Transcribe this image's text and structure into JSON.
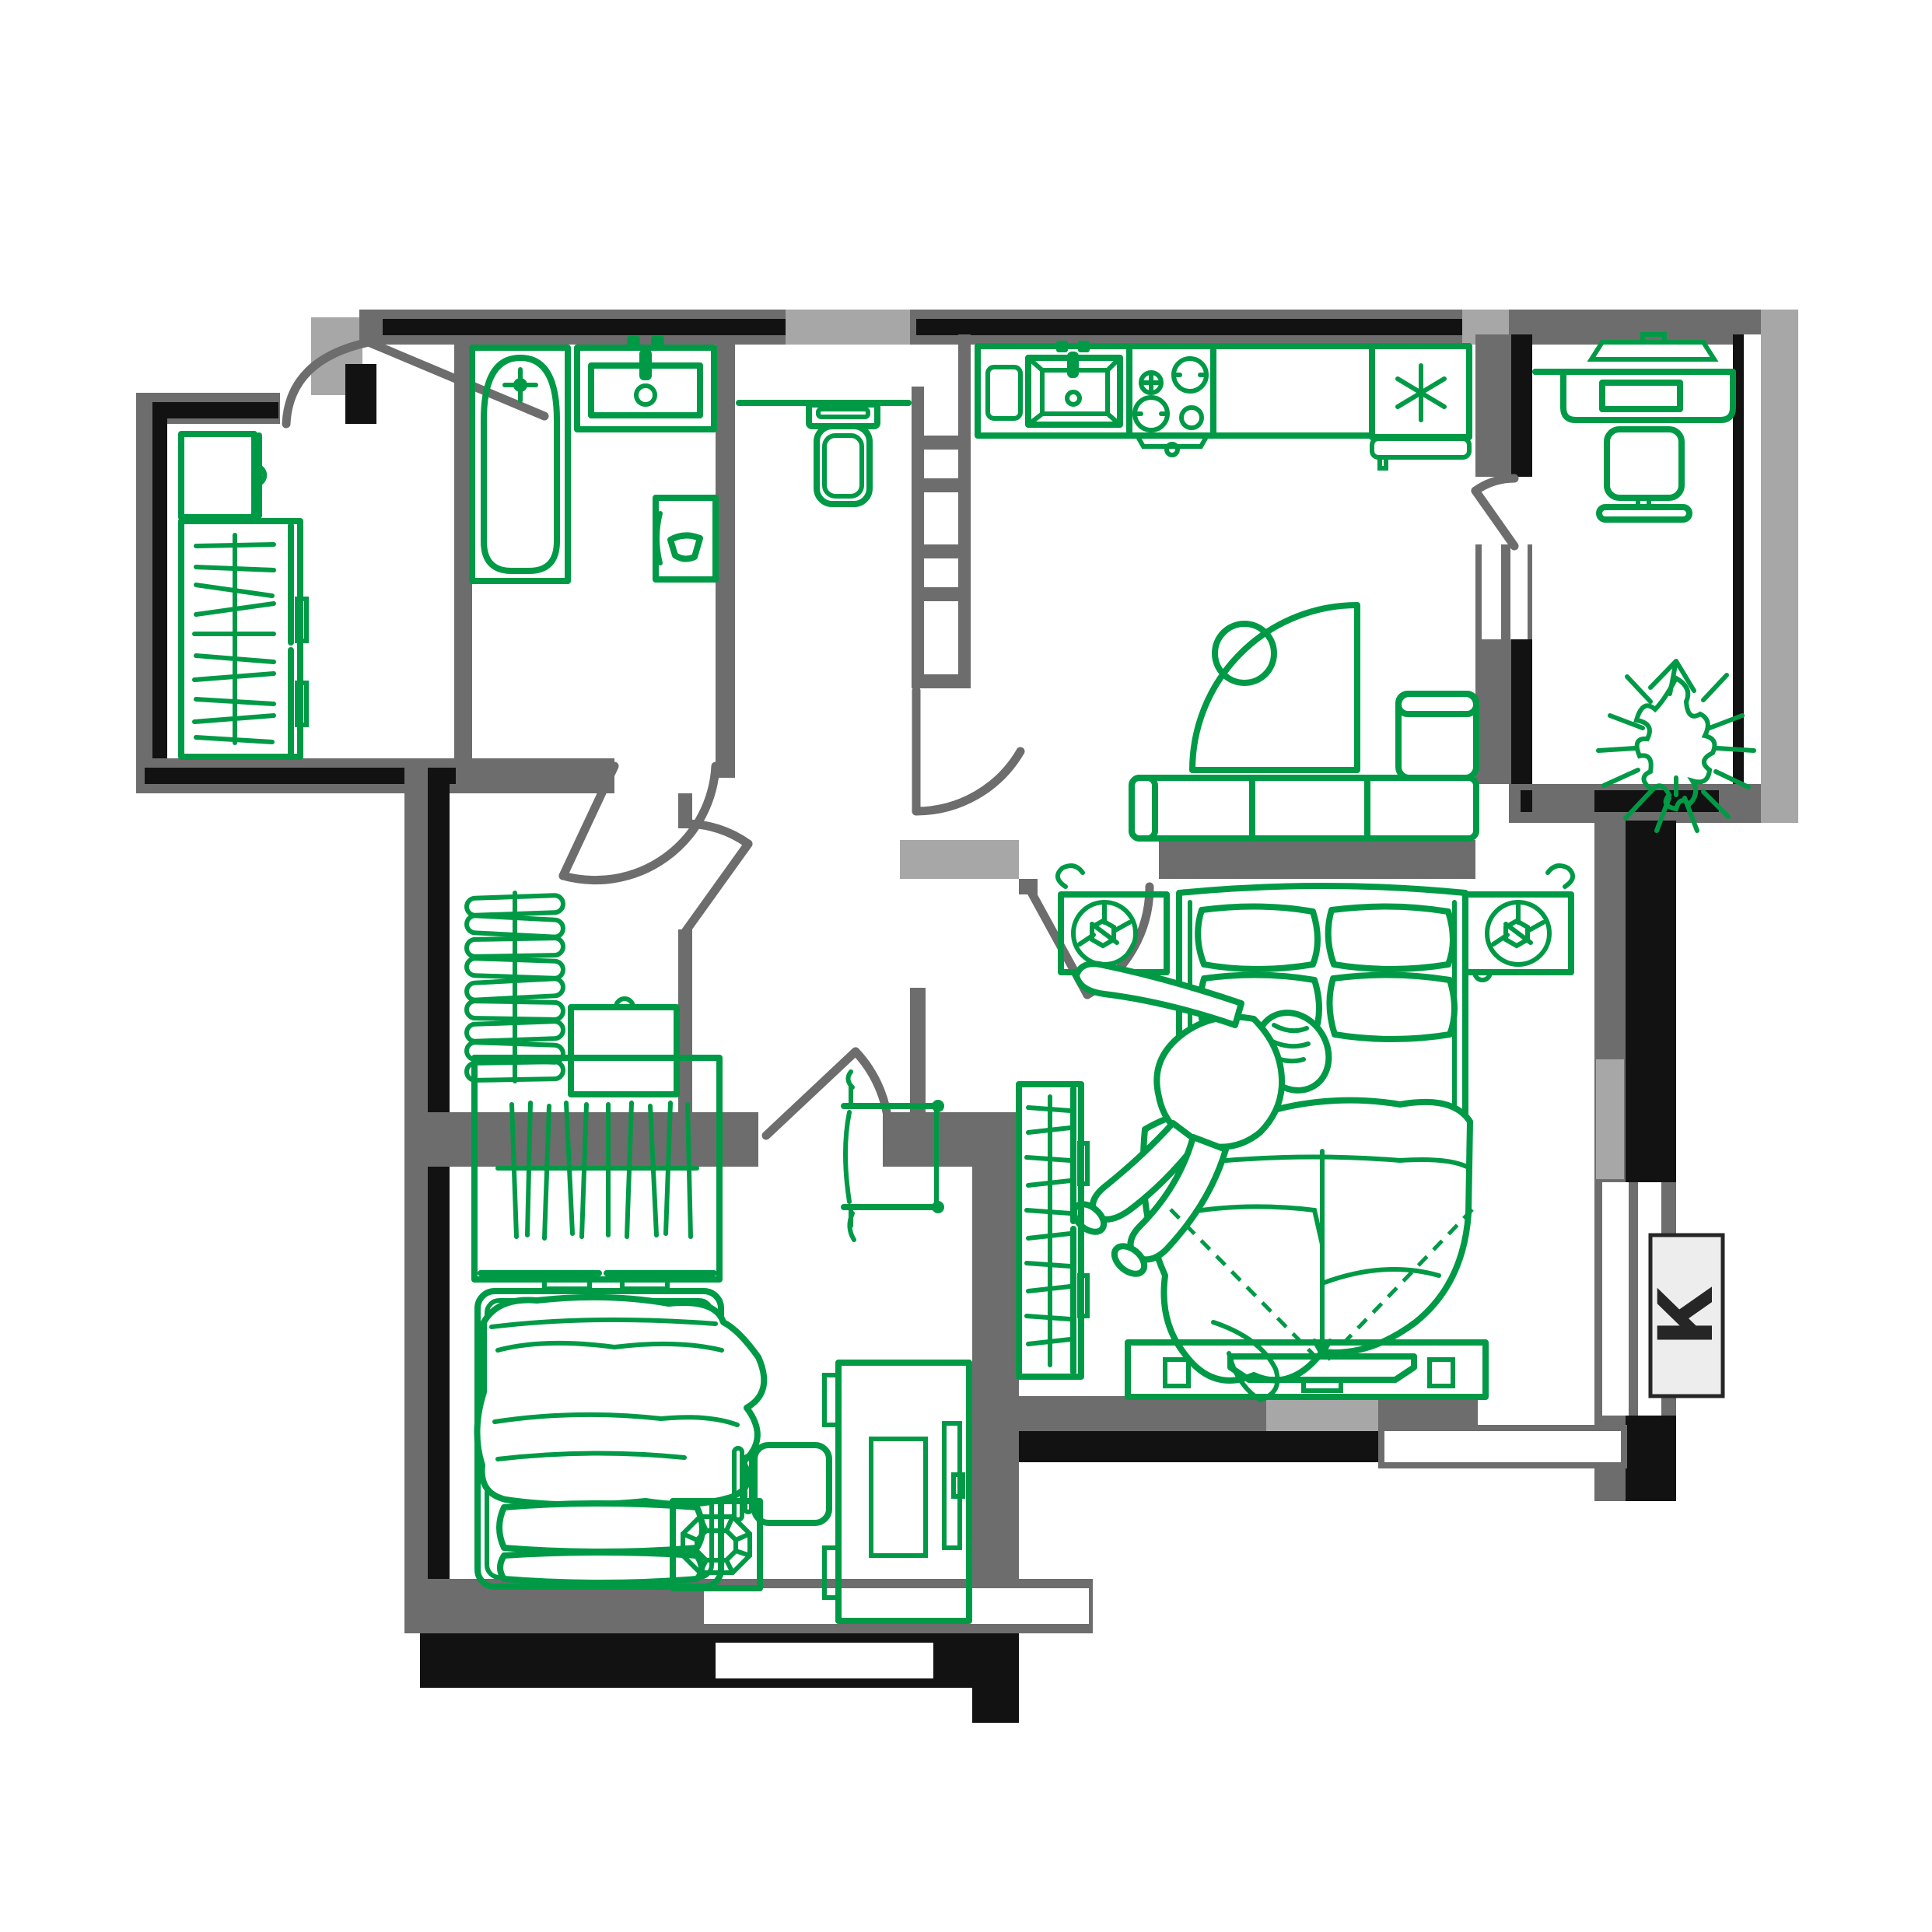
{
  "plan_title": "2-room apartment floor plan",
  "label_box": {
    "text": "К"
  },
  "palette": {
    "furniture_green": "#009a46",
    "wall_dark_gray": "#6d6d6d",
    "wall_black": "#121212",
    "wall_light_gray": "#a7a7a7",
    "background": "#ffffff",
    "label_background": "#ecedec",
    "label_text_color": "#262626"
  },
  "rooms": [
    {
      "name": "entry-hall",
      "furniture": [
        "shoe-cabinet",
        "wardrobe-with-hangers"
      ]
    },
    {
      "name": "bathroom",
      "furniture": [
        "bathtub",
        "sink",
        "washing-machine"
      ]
    },
    {
      "name": "wc",
      "furniture": [
        "toilet",
        "shelf"
      ]
    },
    {
      "name": "ventilation-shaft",
      "furniture": []
    },
    {
      "name": "kitchen-living-room",
      "furniture": [
        "kitchen-counter",
        "cutting-board",
        "kitchen-sink",
        "stove",
        "fridge",
        "quarter-round-table",
        "stool",
        "corner-sofa"
      ]
    },
    {
      "name": "loggia",
      "furniture": [
        "shelf",
        "desk",
        "monitor",
        "chair",
        "plant"
      ]
    },
    {
      "name": "master-bedroom",
      "furniture": [
        "double-bed",
        "person",
        "nightstand-left",
        "nightstand-right",
        "wardrobe",
        "tv-stand",
        "tv",
        "viewing-lines"
      ]
    },
    {
      "name": "kids-room",
      "furniture": [
        "wardrobe-with-hangers",
        "single-bed",
        "pouf",
        "desk",
        "chair",
        "monitor",
        "drying-rack"
      ]
    },
    {
      "name": "closet",
      "furniture": [
        "coat-rack-coil",
        "appliance-box"
      ]
    }
  ]
}
